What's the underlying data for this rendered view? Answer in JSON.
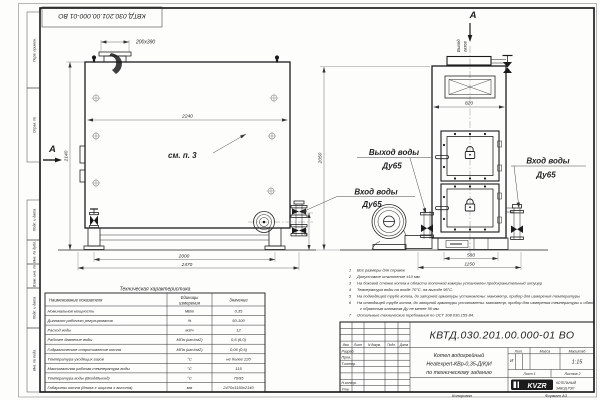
{
  "page": {
    "stamp_top": "КВТД.030.201.00.000-01 ВО",
    "copied_label": "Копировал",
    "format_label": "Формат А3"
  },
  "margin": {
    "labels": [
      "Перв. примен.",
      "Справ. №",
      "Подп. и дата",
      "Инв. № дубл.",
      "Взам. инв. №",
      "Подп. и дата",
      "Инв. № подл."
    ]
  },
  "side_view": {
    "section_label": "А",
    "dim_stub": "200х390",
    "dim_width": "2240",
    "dim_height": "2140",
    "dim_feet": "2000",
    "dim_length": "2470",
    "dim_valve": "255",
    "callout": "см. п. 3",
    "inlet_line1": "Вход воды",
    "inlet_line2": "Ду65"
  },
  "front_view": {
    "section_label": "А",
    "gas_line1": "Выход",
    "gas_line2": "газов",
    "dim_width": "820",
    "dim_height": "2050",
    "dim_base": "580",
    "dim_overall": "1150",
    "outlet_line1": "Выход воды",
    "outlet_line2": "Ду65",
    "inlet_line1": "Вход воды",
    "inlet_line2": "Ду65"
  },
  "tech_table": {
    "title": "Техническая характеристика",
    "col1": "Наименование показателя",
    "col2a": "Единицы",
    "col2b": "измерения",
    "col3": "Значение",
    "rows": [
      [
        "Номинальная мощность",
        "МВт",
        "0,35"
      ],
      [
        "Диапазон рабочего регулирования",
        "%",
        "50-100"
      ],
      [
        "Расход воды",
        "м3/ч",
        "12"
      ],
      [
        "Рабочее давление воды",
        "МПа (кгс/см2)",
        "0,6 (6,0)"
      ],
      [
        "Гидравлическое сопротивление котла",
        "МПа (кгс/см2)",
        "0,06 (0,6)"
      ],
      [
        "Температура уходящих газов",
        "°С",
        "не более 220"
      ],
      [
        "Максимальная рабочая температура воды",
        "°С",
        "115"
      ],
      [
        "Температура воды (Вход/Выход)",
        "°С",
        "70/95"
      ],
      [
        "Габариты котла (длина х ширина х высота)",
        "мм",
        "2470х1150х2140"
      ]
    ]
  },
  "notes": [
    {
      "num": "1",
      "text": "Все размеры для справок"
    },
    {
      "num": "2",
      "text": "Допустимое отклонение ±10 мм."
    },
    {
      "num": "3",
      "text": "На боковой стенке котла в области топочной камеры установлен предохранительный штуцер"
    },
    {
      "num": "4",
      "text": "Температура воды на входе 70°С, на выходе 95°С."
    },
    {
      "num": "5",
      "text": "На подводящей трубе котла, до запорной арматуры установлены: манометр, прибор для измерения температуры"
    },
    {
      "num": "6",
      "text": "На отводящей трубе котла, до запорной арматуры установлены: манометр, прибор для измерения температуры и обвод",
      "text2": "с обратным клапаном Ду не менее 50 мм."
    },
    {
      "num": "7",
      "text": "Остальные технические требования по ОСТ 108.030.155-84."
    }
  ],
  "title_block": {
    "doc_number": "КВТД.030.201.00.000-01 ВО",
    "name_line1": "Котел водогрейный",
    "name_line2": "Heatexpert-КВр-0,35-Д(К)И",
    "name_line3": "по техническому заданию",
    "h_izm": "Изм.",
    "h_list": "Лист",
    "h_doc": "N докум.",
    "h_sign": "Подп.",
    "h_date": "Дата",
    "r1": "Разраб.",
    "r2": "Пров.",
    "r3": "Т.контр.",
    "r4": "Н.контр.",
    "r5": "Утв.",
    "h_lit": "Лит.",
    "h_mass": "Масса",
    "h_scale": "Масштаб",
    "lit": "И",
    "scale": "1:15",
    "sheet": "Лист 1",
    "sheets": "Листов 2",
    "logo": "KVZR",
    "company1": "КОТЕЛЬНЫЙ",
    "company2": "ЗАВОД РЭП"
  }
}
